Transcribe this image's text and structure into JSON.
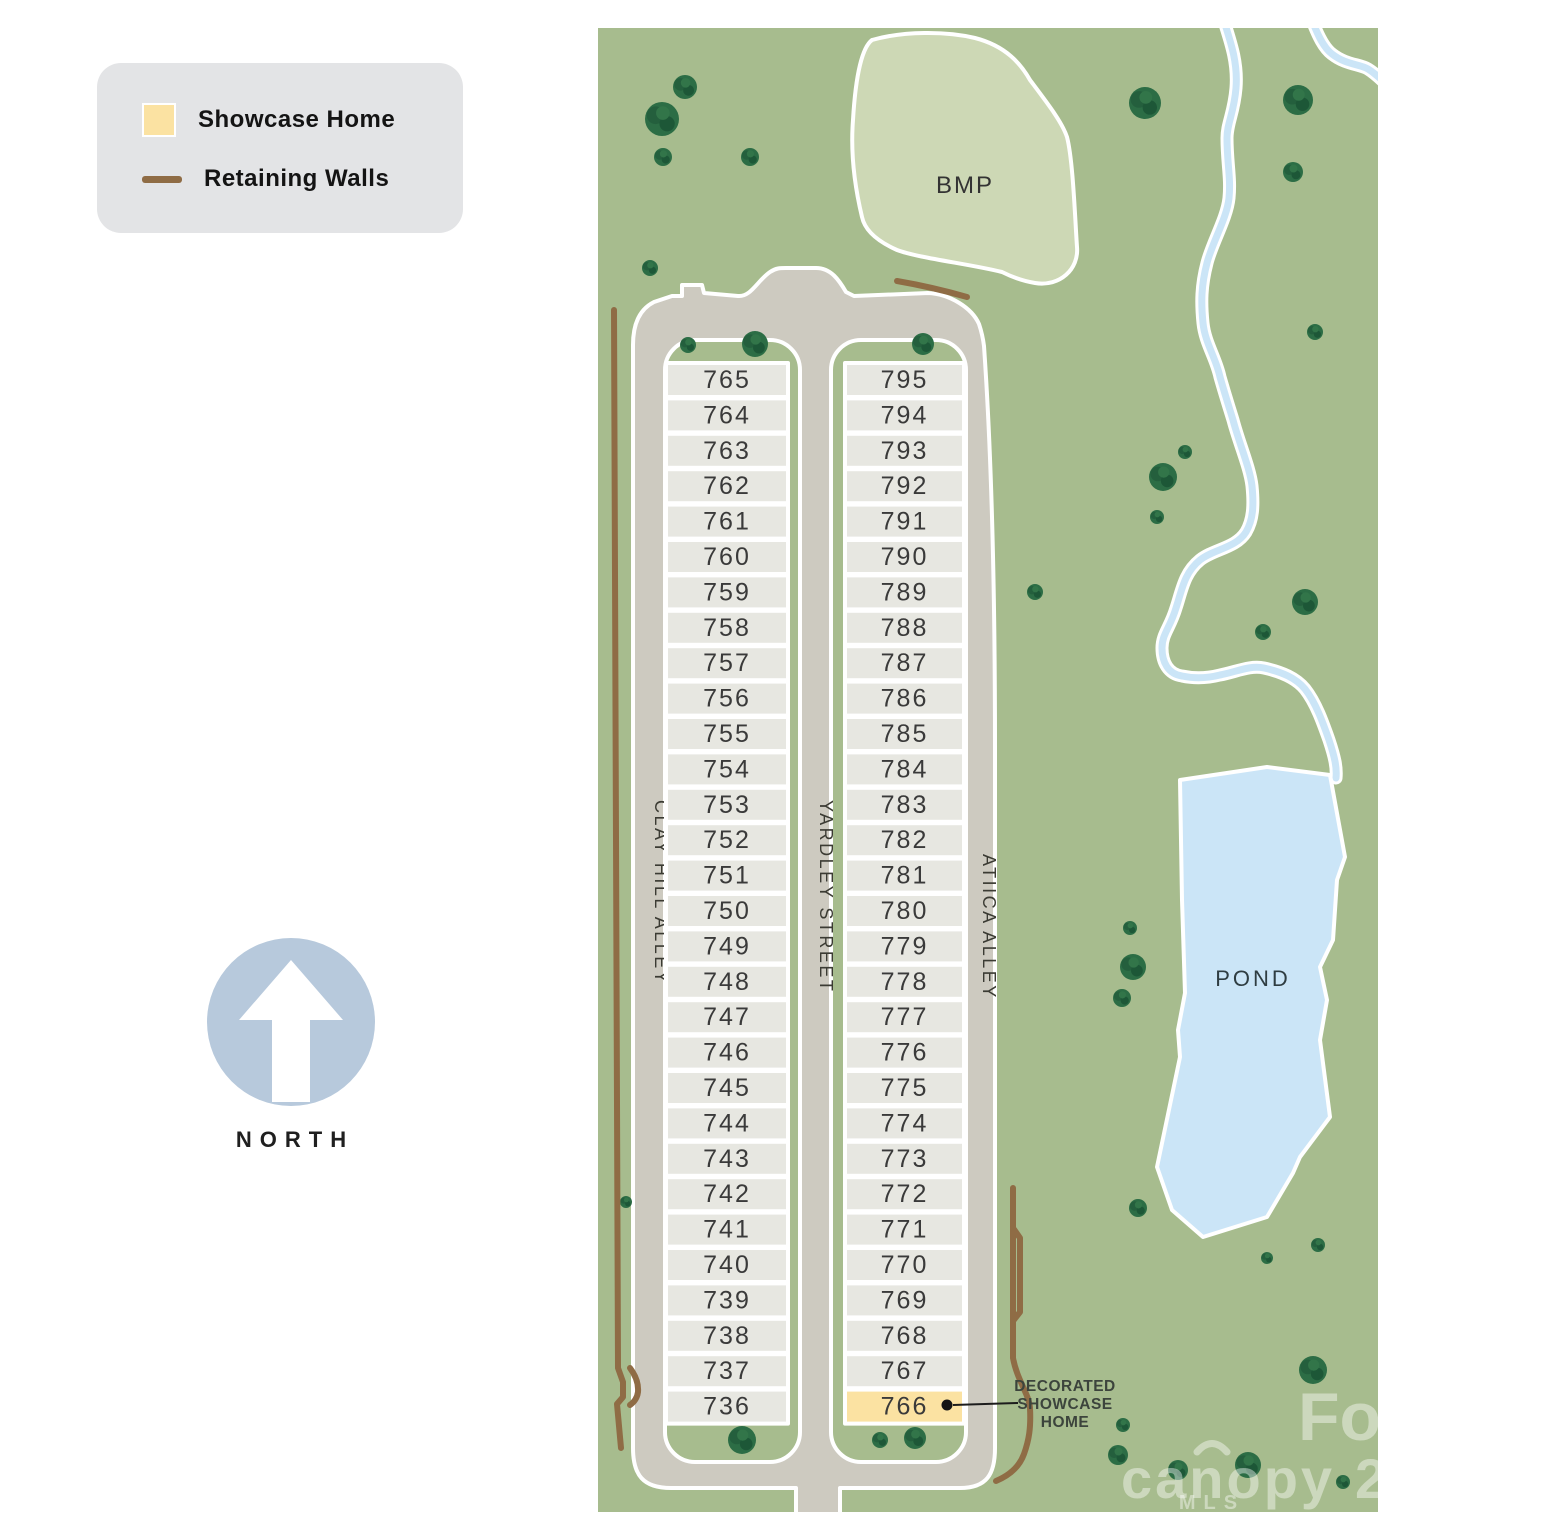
{
  "legend": {
    "showcase_label": "Showcase Home",
    "retaining_label": "Retaining Walls"
  },
  "compass": {
    "label": "NORTH"
  },
  "map": {
    "bmp_label": "BMP",
    "pond_label": "POND",
    "streets": [
      {
        "name": "CLAY HILL ALLEY"
      },
      {
        "name": "YARDLEY STREET"
      },
      {
        "name": "ATIICA ALLEY"
      }
    ],
    "lot_columns": [
      {
        "street": "Clay Hill Alley",
        "lots": [
          "765",
          "764",
          "763",
          "762",
          "761",
          "760",
          "759",
          "758",
          "757",
          "756",
          "755",
          "754",
          "753",
          "752",
          "751",
          "750",
          "749",
          "748",
          "747",
          "746",
          "745",
          "744",
          "743",
          "742",
          "741",
          "740",
          "739",
          "738",
          "737",
          "736"
        ]
      },
      {
        "street": "Atiica Alley",
        "lots": [
          "795",
          "794",
          "793",
          "792",
          "791",
          "790",
          "789",
          "788",
          "787",
          "786",
          "785",
          "784",
          "783",
          "782",
          "781",
          "780",
          "779",
          "778",
          "777",
          "776",
          "775",
          "774",
          "773",
          "772",
          "771",
          "770",
          "769",
          "768",
          "767",
          "766"
        ]
      }
    ],
    "showcase_lot": "766",
    "callout": {
      "lines": [
        "DECORATED",
        "SHOWCASE",
        "HOME"
      ]
    },
    "watermark": {
      "line1": "For",
      "brand": "canopy",
      "sub": "MLS",
      "suffix": "2"
    }
  },
  "colors": {
    "map_green": "#a7bc8e",
    "bmp_green": "#cdd8b5",
    "road_grey": "#cdcac0",
    "lot_grey": "#e7e7e1",
    "showcase_yellow": "#fbe2a2",
    "water_blue": "#cbe5f7",
    "tree_green": "#2c6d45",
    "wall_brown": "#8f6c45",
    "legend_bg": "#e3e4e6",
    "compass_blue": "#b7c9dc"
  }
}
